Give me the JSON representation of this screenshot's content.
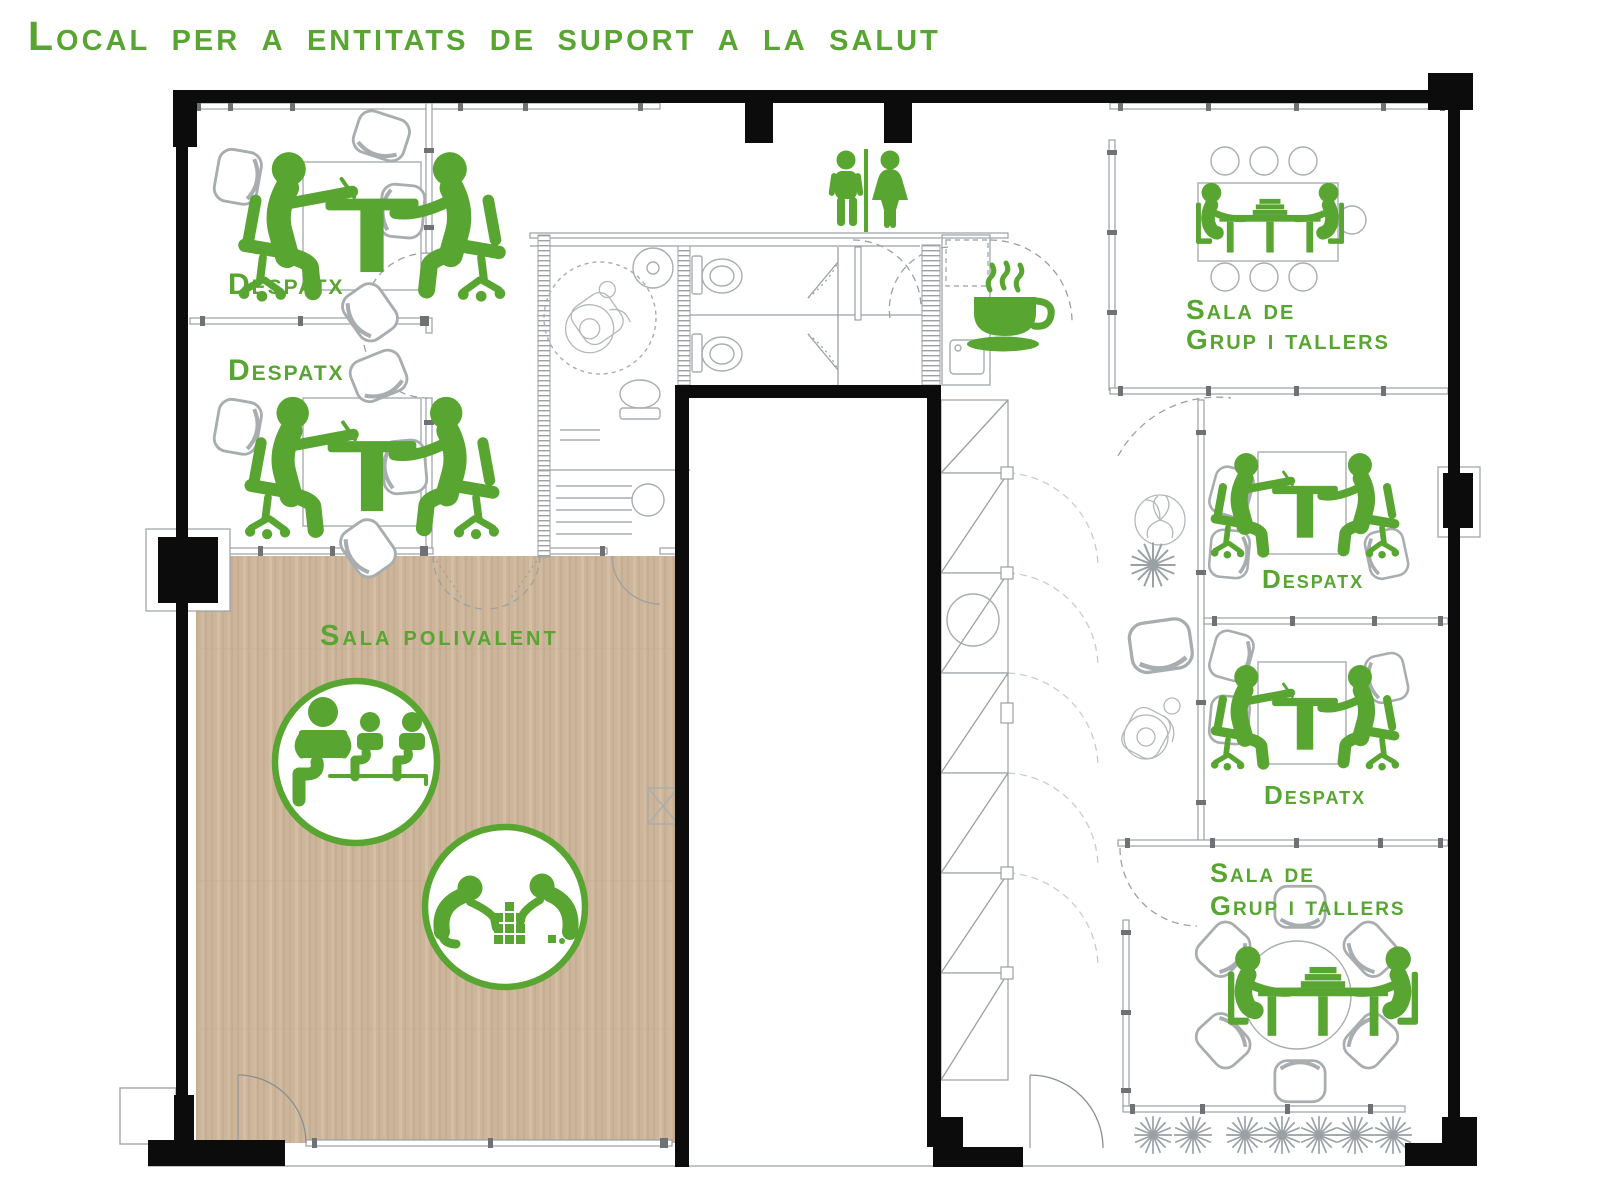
{
  "title": "Local per a entitats de suport a la salut",
  "colors": {
    "accent_green": "#58a531",
    "wall_black": "#0c0c0c",
    "partition_gray": "#9aa0a3",
    "furniture_gray": "#a8adb0",
    "wood_floor": "#ccb59b"
  },
  "rooms": {
    "despatx_1": {
      "label": "Despatx"
    },
    "despatx_2": {
      "label": "Despatx"
    },
    "despatx_3": {
      "label": "Despatx"
    },
    "despatx_4": {
      "label": "Despatx"
    },
    "sala_grup_tallers_top": {
      "line1": "Sala de",
      "line2": "Grup i tallers"
    },
    "sala_grup_tallers_bottom": {
      "line1": "Sala de",
      "line2": "Grup i tallers"
    },
    "sala_polivalent": {
      "label": "Sala polivalent"
    }
  },
  "icons": {
    "restroom_sign": "men-women-toilets",
    "coffee_area": "coffee-cup",
    "despatx_rooms": "two-people-at-desk",
    "group_rooms": "two-people-at-meeting-table",
    "polivalent_activities": [
      "seated-group-activity",
      "children-playing-blocks"
    ]
  }
}
